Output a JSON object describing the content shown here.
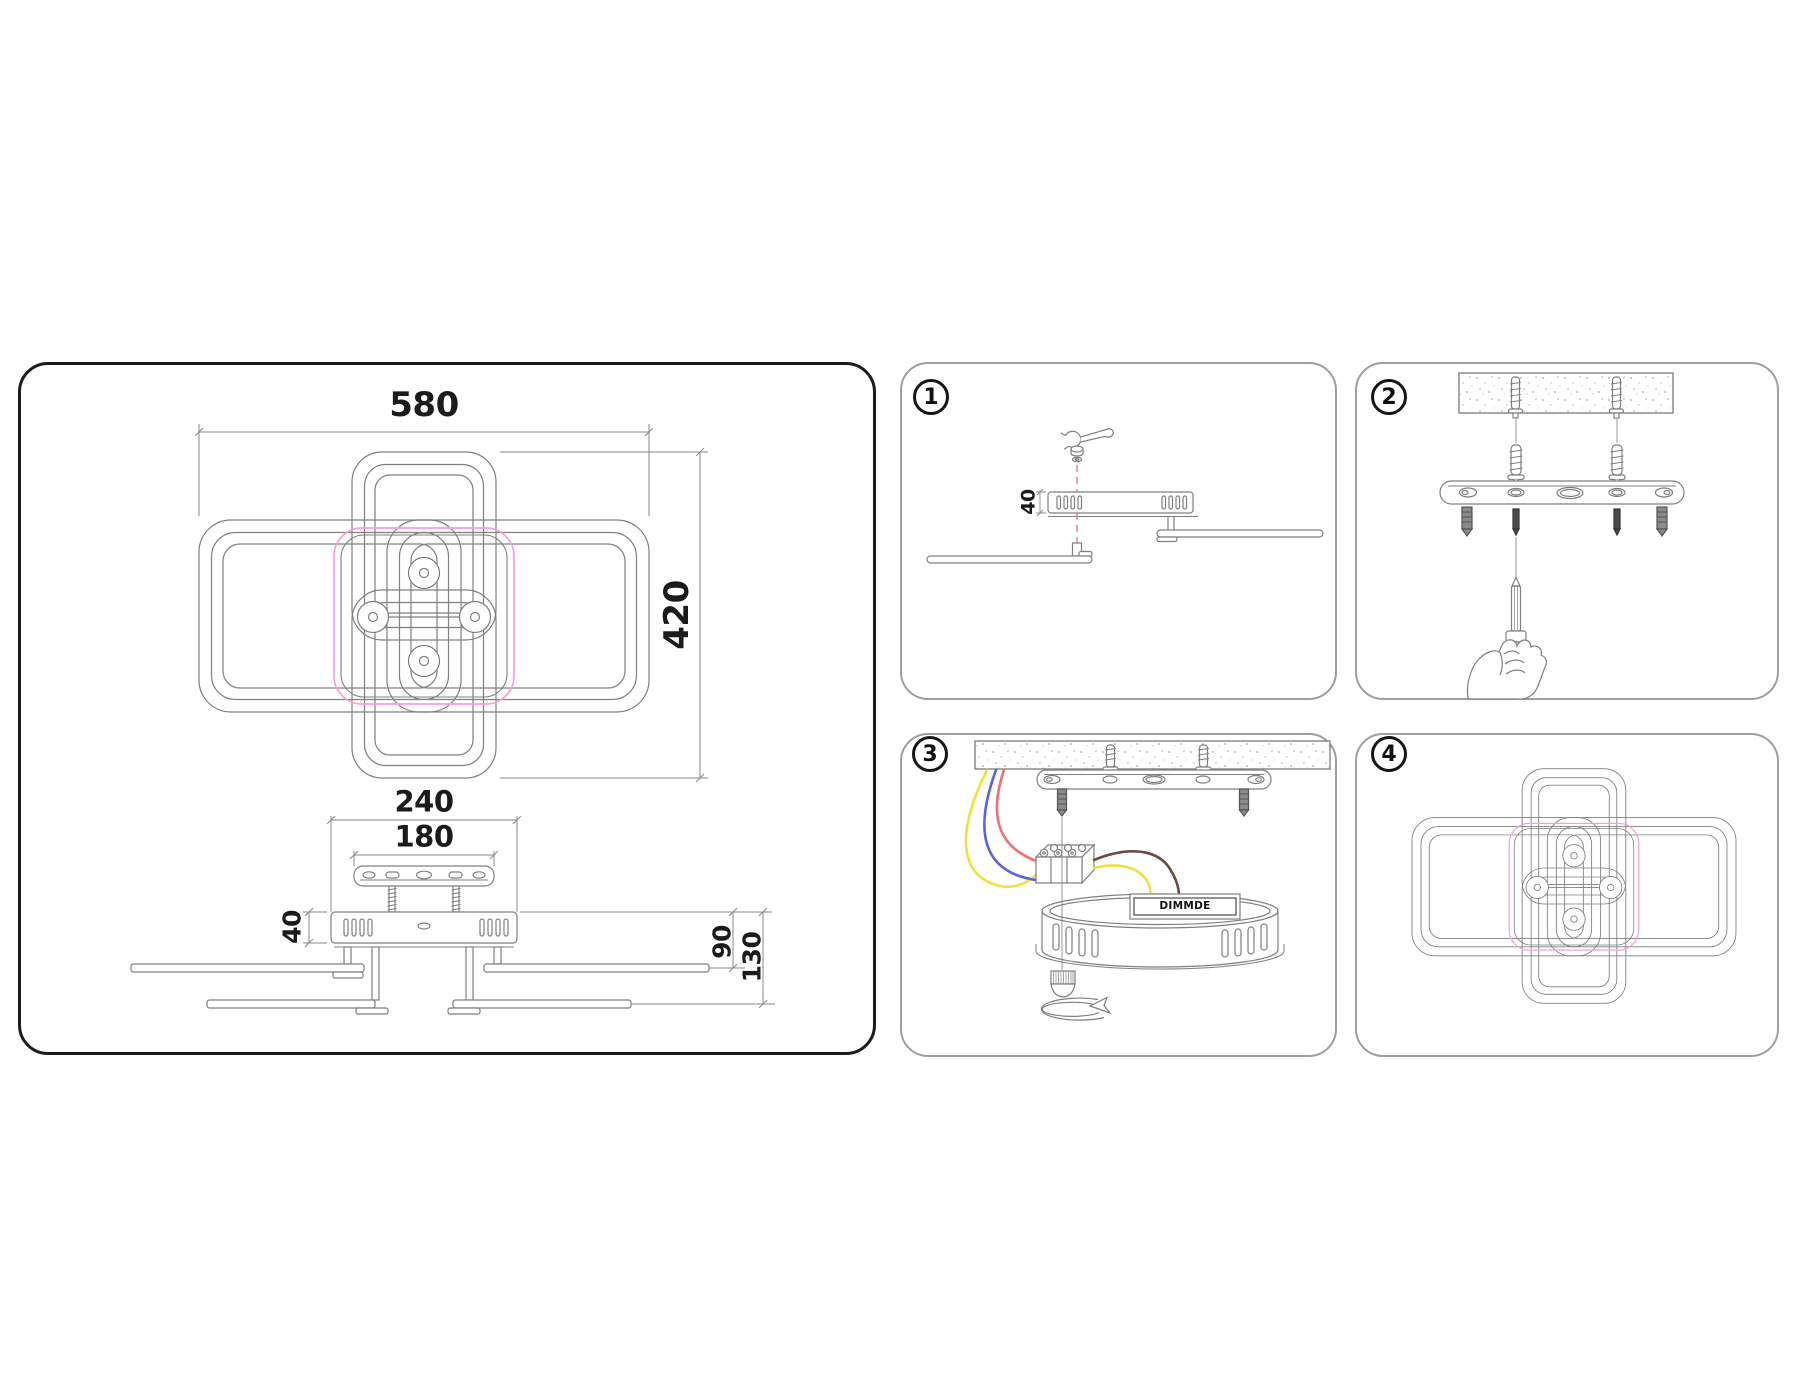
{
  "sheet": {
    "dimensions": {
      "overall_width": "580",
      "overall_height": "420",
      "canopy_width": "240",
      "plate_width": "180",
      "body_height": "40",
      "upper_ring_drop": "90",
      "lower_ring_drop": "130"
    },
    "steps": [
      {
        "number": "1",
        "dimension": "40"
      },
      {
        "number": "2"
      },
      {
        "number": "3",
        "module_label": "DIMMDE"
      },
      {
        "number": "4"
      }
    ],
    "colors": {
      "line": "#7f7f7f",
      "outline_black": "#1c1c1c",
      "canopy_pink": "#f59fdf",
      "axis_red": "#ef8f8f",
      "wire_yellow": "#efdf3f",
      "wire_blue": "#5a64e0",
      "wire_red": "#ef7070",
      "wire_brown": "#6d4a42"
    }
  }
}
